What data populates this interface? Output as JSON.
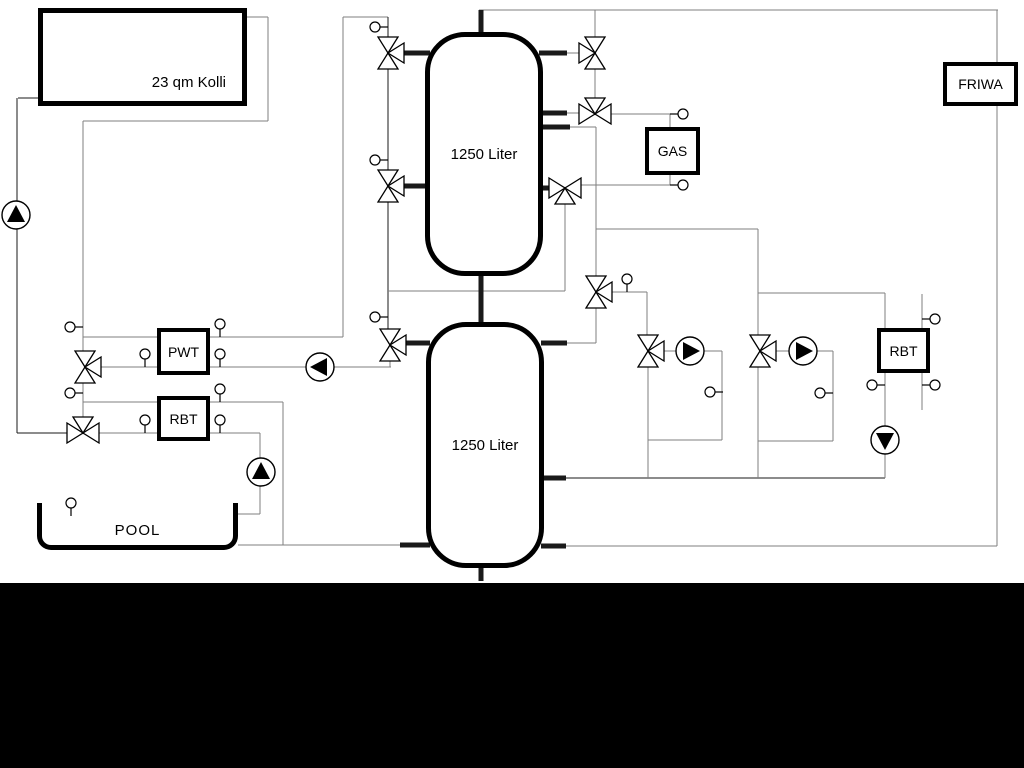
{
  "labels": {
    "collector": "23 qm Kolli",
    "tank_top": "1250 Liter",
    "tank_bottom": "1250 Liter",
    "gas": "GAS",
    "friwa": "FRIWA",
    "pwt": "PWT",
    "rbt_left": "RBT",
    "rbt_right": "RBT",
    "pool": "POOL"
  },
  "colors": {
    "line_dark": "#1a1a1a",
    "line_gray": "#7f7f7f",
    "component_stroke": "#000000",
    "component_fill": "#ffffff",
    "letterbox": "#000000"
  },
  "schematic": {
    "pipes": [
      {
        "x1": 479,
        "y1": 10,
        "x2": 998,
        "y2": 10,
        "c": "g"
      },
      {
        "x1": 997,
        "y1": 10,
        "x2": 997,
        "y2": 62,
        "c": "g"
      },
      {
        "x1": 997,
        "y1": 106,
        "x2": 997,
        "y2": 546,
        "c": "g"
      },
      {
        "x1": 565,
        "y1": 546,
        "x2": 997,
        "y2": 546,
        "c": "g"
      },
      {
        "x1": 541,
        "y1": 546,
        "x2": 566,
        "y2": 546,
        "c": "k",
        "w": 5
      },
      {
        "x1": 18,
        "y1": 98,
        "x2": 40,
        "y2": 98,
        "c": "k"
      },
      {
        "x1": 17,
        "y1": 98,
        "x2": 17,
        "y2": 202,
        "c": "k"
      },
      {
        "x1": 17,
        "y1": 228,
        "x2": 17,
        "y2": 433,
        "c": "k"
      },
      {
        "x1": 17,
        "y1": 433,
        "x2": 68,
        "y2": 433,
        "c": "k"
      },
      {
        "x1": 245,
        "y1": 17,
        "x2": 268,
        "y2": 17,
        "c": "g"
      },
      {
        "x1": 268,
        "y1": 17,
        "x2": 268,
        "y2": 121,
        "c": "g"
      },
      {
        "x1": 83,
        "y1": 121,
        "x2": 268,
        "y2": 121,
        "c": "g"
      },
      {
        "x1": 83,
        "y1": 121,
        "x2": 83,
        "y2": 352,
        "c": "g"
      },
      {
        "x1": 83,
        "y1": 382,
        "x2": 83,
        "y2": 418,
        "c": "g"
      },
      {
        "x1": 83,
        "y1": 337,
        "x2": 157,
        "y2": 337,
        "c": "g"
      },
      {
        "x1": 210,
        "y1": 337,
        "x2": 343,
        "y2": 337,
        "c": "g"
      },
      {
        "x1": 343,
        "y1": 17,
        "x2": 343,
        "y2": 337,
        "c": "g"
      },
      {
        "x1": 343,
        "y1": 17,
        "x2": 388,
        "y2": 17,
        "c": "g"
      },
      {
        "x1": 83,
        "y1": 402,
        "x2": 157,
        "y2": 402,
        "c": "g"
      },
      {
        "x1": 210,
        "y1": 402,
        "x2": 283,
        "y2": 402,
        "c": "g"
      },
      {
        "x1": 283,
        "y1": 402,
        "x2": 283,
        "y2": 545,
        "c": "g"
      },
      {
        "x1": 238,
        "y1": 545,
        "x2": 283,
        "y2": 545,
        "c": "g"
      },
      {
        "x1": 283,
        "y1": 545,
        "x2": 404,
        "y2": 545,
        "c": "g"
      },
      {
        "x1": 400,
        "y1": 545,
        "x2": 430,
        "y2": 545,
        "c": "k",
        "w": 5
      },
      {
        "x1": 98,
        "y1": 433,
        "x2": 157,
        "y2": 433,
        "c": "g"
      },
      {
        "x1": 210,
        "y1": 433,
        "x2": 260,
        "y2": 433,
        "c": "g"
      },
      {
        "x1": 260,
        "y1": 433,
        "x2": 260,
        "y2": 458,
        "c": "g"
      },
      {
        "x1": 260,
        "y1": 486,
        "x2": 260,
        "y2": 514,
        "c": "g"
      },
      {
        "x1": 238,
        "y1": 514,
        "x2": 260,
        "y2": 514,
        "c": "g"
      },
      {
        "x1": 100,
        "y1": 367,
        "x2": 157,
        "y2": 367,
        "c": "g"
      },
      {
        "x1": 210,
        "y1": 367,
        "x2": 306,
        "y2": 367,
        "c": "g"
      },
      {
        "x1": 334,
        "y1": 367,
        "x2": 391,
        "y2": 367,
        "c": "g"
      },
      {
        "x1": 390,
        "y1": 360,
        "x2": 390,
        "y2": 367,
        "c": "g"
      },
      {
        "x1": 388,
        "y1": 17,
        "x2": 388,
        "y2": 38,
        "c": "k"
      },
      {
        "x1": 388,
        "y1": 68,
        "x2": 388,
        "y2": 171,
        "c": "k"
      },
      {
        "x1": 388,
        "y1": 201,
        "x2": 388,
        "y2": 330,
        "c": "k"
      },
      {
        "x1": 388,
        "y1": 291,
        "x2": 565,
        "y2": 291,
        "c": "g"
      },
      {
        "x1": 565,
        "y1": 203,
        "x2": 565,
        "y2": 291,
        "c": "g"
      },
      {
        "x1": 402,
        "y1": 53,
        "x2": 430,
        "y2": 53,
        "c": "k",
        "w": 5
      },
      {
        "x1": 402,
        "y1": 186,
        "x2": 430,
        "y2": 186,
        "c": "k",
        "w": 5
      },
      {
        "x1": 404,
        "y1": 343,
        "x2": 430,
        "y2": 343,
        "c": "k",
        "w": 5
      },
      {
        "x1": 539,
        "y1": 53,
        "x2": 567,
        "y2": 53,
        "c": "k",
        "w": 5
      },
      {
        "x1": 567,
        "y1": 53,
        "x2": 580,
        "y2": 53,
        "c": "g"
      },
      {
        "x1": 539,
        "y1": 113,
        "x2": 567,
        "y2": 113,
        "c": "k",
        "w": 5
      },
      {
        "x1": 567,
        "y1": 113,
        "x2": 580,
        "y2": 113,
        "c": "g"
      },
      {
        "x1": 539,
        "y1": 127,
        "x2": 570,
        "y2": 127,
        "c": "k",
        "w": 5
      },
      {
        "x1": 570,
        "y1": 127,
        "x2": 596,
        "y2": 127,
        "c": "g"
      },
      {
        "x1": 539,
        "y1": 188,
        "x2": 550,
        "y2": 188,
        "c": "k",
        "w": 5
      },
      {
        "x1": 541,
        "y1": 343,
        "x2": 567,
        "y2": 343,
        "c": "k",
        "w": 5
      },
      {
        "x1": 567,
        "y1": 343,
        "x2": 596,
        "y2": 343,
        "c": "g"
      },
      {
        "x1": 541,
        "y1": 478,
        "x2": 566,
        "y2": 478,
        "c": "k",
        "w": 5
      },
      {
        "x1": 566,
        "y1": 478,
        "x2": 885,
        "y2": 478,
        "c": "k"
      },
      {
        "x1": 481,
        "y1": 10,
        "x2": 481,
        "y2": 36,
        "c": "k",
        "w": 5
      },
      {
        "x1": 481,
        "y1": 273,
        "x2": 481,
        "y2": 325,
        "c": "k",
        "w": 5
      },
      {
        "x1": 481,
        "y1": 565,
        "x2": 481,
        "y2": 581,
        "c": "k",
        "w": 5
      },
      {
        "x1": 595,
        "y1": 10,
        "x2": 595,
        "y2": 38,
        "c": "g"
      },
      {
        "x1": 595,
        "y1": 68,
        "x2": 595,
        "y2": 99,
        "c": "g"
      },
      {
        "x1": 610,
        "y1": 114,
        "x2": 670,
        "y2": 114,
        "c": "g"
      },
      {
        "x1": 670,
        "y1": 114,
        "x2": 670,
        "y2": 127,
        "c": "g"
      },
      {
        "x1": 670,
        "y1": 175,
        "x2": 670,
        "y2": 185,
        "c": "g"
      },
      {
        "x1": 580,
        "y1": 185,
        "x2": 670,
        "y2": 185,
        "c": "g"
      },
      {
        "x1": 596,
        "y1": 127,
        "x2": 596,
        "y2": 277,
        "c": "g"
      },
      {
        "x1": 596,
        "y1": 229,
        "x2": 758,
        "y2": 229,
        "c": "g"
      },
      {
        "x1": 758,
        "y1": 229,
        "x2": 758,
        "y2": 336,
        "c": "g"
      },
      {
        "x1": 758,
        "y1": 293,
        "x2": 885,
        "y2": 293,
        "c": "g"
      },
      {
        "x1": 885,
        "y1": 293,
        "x2": 885,
        "y2": 328,
        "c": "g"
      },
      {
        "x1": 611,
        "y1": 292,
        "x2": 647,
        "y2": 292,
        "c": "g"
      },
      {
        "x1": 647,
        "y1": 292,
        "x2": 647,
        "y2": 336,
        "c": "g"
      },
      {
        "x1": 596,
        "y1": 307,
        "x2": 596,
        "y2": 343,
        "c": "g"
      },
      {
        "x1": 663,
        "y1": 351,
        "x2": 677,
        "y2": 351,
        "c": "g"
      },
      {
        "x1": 704,
        "y1": 351,
        "x2": 722,
        "y2": 351,
        "c": "g"
      },
      {
        "x1": 722,
        "y1": 351,
        "x2": 722,
        "y2": 440,
        "c": "g"
      },
      {
        "x1": 648,
        "y1": 440,
        "x2": 722,
        "y2": 440,
        "c": "g"
      },
      {
        "x1": 648,
        "y1": 366,
        "x2": 648,
        "y2": 478,
        "c": "g"
      },
      {
        "x1": 775,
        "y1": 351,
        "x2": 790,
        "y2": 351,
        "c": "g"
      },
      {
        "x1": 816,
        "y1": 351,
        "x2": 833,
        "y2": 351,
        "c": "g"
      },
      {
        "x1": 833,
        "y1": 351,
        "x2": 833,
        "y2": 441,
        "c": "g"
      },
      {
        "x1": 758,
        "y1": 441,
        "x2": 833,
        "y2": 441,
        "c": "g"
      },
      {
        "x1": 758,
        "y1": 366,
        "x2": 758,
        "y2": 478,
        "c": "g"
      },
      {
        "x1": 885,
        "y1": 373,
        "x2": 885,
        "y2": 426,
        "c": "g"
      },
      {
        "x1": 885,
        "y1": 454,
        "x2": 885,
        "y2": 478,
        "c": "g"
      },
      {
        "x1": 922,
        "y1": 294,
        "x2": 922,
        "y2": 328,
        "c": "g"
      },
      {
        "x1": 922,
        "y1": 373,
        "x2": 922,
        "y2": 410,
        "c": "g"
      }
    ],
    "valves": [
      {
        "x": 388,
        "y": 53,
        "axis": "v",
        "t": "E"
      },
      {
        "x": 388,
        "y": 186,
        "axis": "v",
        "t": "E"
      },
      {
        "x": 390,
        "y": 345,
        "axis": "v",
        "t": "E"
      },
      {
        "x": 85,
        "y": 367,
        "axis": "v",
        "t": "E"
      },
      {
        "x": 83,
        "y": 433,
        "axis": "h",
        "t": "N"
      },
      {
        "x": 595,
        "y": 53,
        "axis": "v",
        "t": "W"
      },
      {
        "x": 595,
        "y": 114,
        "axis": "h",
        "t": "N"
      },
      {
        "x": 565,
        "y": 188,
        "axis": "h",
        "t": "S"
      },
      {
        "x": 596,
        "y": 292,
        "axis": "v",
        "t": "E"
      },
      {
        "x": 648,
        "y": 351,
        "axis": "v",
        "t": "E"
      },
      {
        "x": 760,
        "y": 351,
        "axis": "v",
        "t": "E"
      }
    ],
    "pumps": [
      {
        "x": 16,
        "y": 215,
        "d": "U"
      },
      {
        "x": 320,
        "y": 367,
        "d": "L"
      },
      {
        "x": 261,
        "y": 472,
        "d": "U"
      },
      {
        "x": 690,
        "y": 351,
        "d": "R"
      },
      {
        "x": 803,
        "y": 351,
        "d": "R"
      },
      {
        "x": 885,
        "y": 440,
        "d": "D"
      }
    ],
    "sensors": [
      {
        "x": 49,
        "y": 57,
        "d": "E"
      },
      {
        "x": 236,
        "y": 22,
        "d": "W"
      },
      {
        "x": 450,
        "y": 51,
        "d": "E"
      },
      {
        "x": 450,
        "y": 117,
        "d": "E"
      },
      {
        "x": 450,
        "y": 183,
        "d": "E"
      },
      {
        "x": 450,
        "y": 249,
        "d": "E"
      },
      {
        "x": 450,
        "y": 340,
        "d": "E"
      },
      {
        "x": 450,
        "y": 406,
        "d": "E"
      },
      {
        "x": 450,
        "y": 472,
        "d": "E"
      },
      {
        "x": 450,
        "y": 539,
        "d": "E"
      },
      {
        "x": 375,
        "y": 27,
        "d": "E"
      },
      {
        "x": 375,
        "y": 160,
        "d": "E"
      },
      {
        "x": 375,
        "y": 317,
        "d": "E"
      },
      {
        "x": 70,
        "y": 327,
        "d": "E"
      },
      {
        "x": 70,
        "y": 393,
        "d": "E"
      },
      {
        "x": 145,
        "y": 354,
        "d": "S"
      },
      {
        "x": 220,
        "y": 324,
        "d": "S"
      },
      {
        "x": 220,
        "y": 354,
        "d": "S"
      },
      {
        "x": 220,
        "y": 389,
        "d": "S"
      },
      {
        "x": 145,
        "y": 420,
        "d": "S"
      },
      {
        "x": 220,
        "y": 420,
        "d": "S"
      },
      {
        "x": 683,
        "y": 114,
        "d": "W"
      },
      {
        "x": 683,
        "y": 185,
        "d": "W"
      },
      {
        "x": 627,
        "y": 279,
        "d": "S"
      },
      {
        "x": 710,
        "y": 392,
        "d": "E"
      },
      {
        "x": 820,
        "y": 393,
        "d": "E"
      },
      {
        "x": 935,
        "y": 319,
        "d": "W"
      },
      {
        "x": 935,
        "y": 385,
        "d": "W"
      },
      {
        "x": 872,
        "y": 385,
        "d": "E"
      },
      {
        "x": 71,
        "y": 503,
        "d": "S"
      }
    ]
  }
}
